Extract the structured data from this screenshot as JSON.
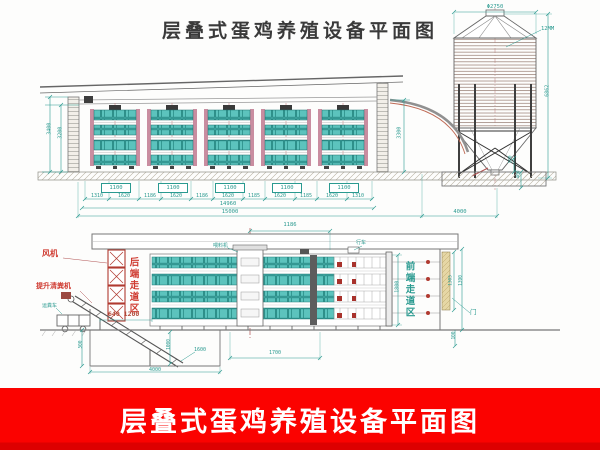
{
  "title": {
    "top": "层叠式蛋鸡养殖设备平面图"
  },
  "banner": {
    "text": "层叠式蛋鸡养殖设备平面图"
  },
  "elevation": {
    "dim_wall_height": "3400",
    "dim_inner_height": "3200",
    "cage_widths": [
      "1100",
      "1100",
      "1100",
      "1100",
      "1100"
    ],
    "dim_chain": [
      "1310",
      "1620",
      "1186",
      "1620",
      "1186",
      "1620",
      "1185",
      "1620",
      "1185",
      "1620",
      "1310"
    ],
    "dim_total_inner": "14960",
    "dim_total_outer": "15000",
    "dim_gap_to_silo": "4000",
    "dim_pipe_drop": "3300"
  },
  "silo": {
    "dim_diameter": "Φ2750",
    "dim_height": "6862",
    "dim_leg_clearance": "100",
    "dim_foundation_depth": "400",
    "wall_note": "12MM"
  },
  "section": {
    "dim_top_offset": "1186",
    "label_fan": "风机",
    "label_manure_lifter": "提升清粪机",
    "label_rear_aisle": "后端走道区",
    "label_front_aisle": "前端走道区",
    "label_cart": "运粪车",
    "label_feeder": "喂料机",
    "label_trolley": "行车",
    "label_door": "门",
    "dim_rear_aisle": "640 1200",
    "dim_cage_height": "1800",
    "dim_cage_row": "1700",
    "dim_pit_width": "4000",
    "dim_pit_depth": "500",
    "dim_pit_inner": "1000",
    "dim_pit_leader": "1600",
    "dim_door_height_inner": "1305",
    "dim_door_height_outer": "1390",
    "dim_footing": "100"
  }
}
